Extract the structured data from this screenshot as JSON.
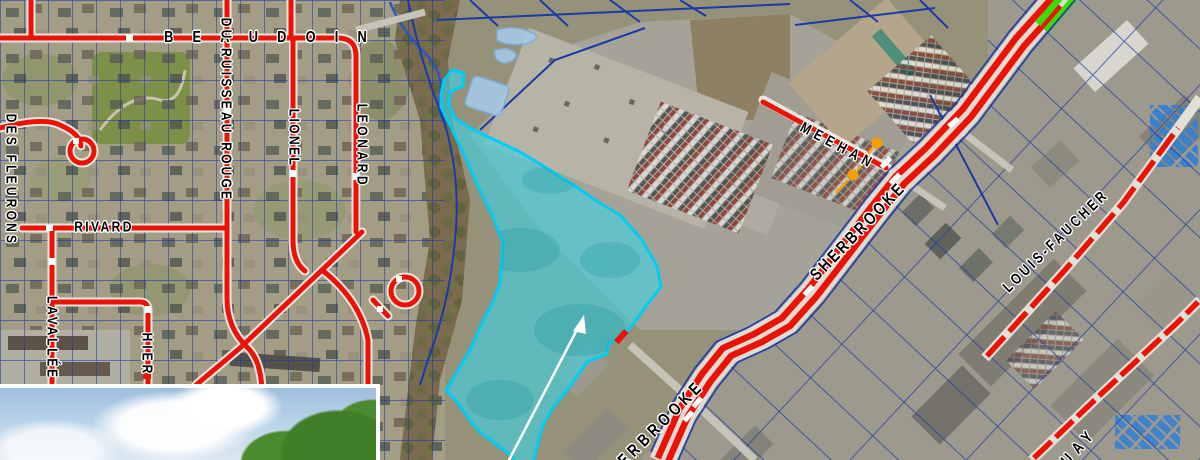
{
  "map": {
    "street_labels": [
      {
        "text": "BEAUDOIN",
        "x": 275,
        "y": 38,
        "rot": 0,
        "fs": 16,
        "ls": 24
      },
      {
        "text": "DU RUISSEAU ROUGE",
        "x": 226,
        "y": 110,
        "rot": 90,
        "fs": 15,
        "ls": 4
      },
      {
        "text": "LIONEL",
        "x": 294,
        "y": 138,
        "rot": 90,
        "fs": 15,
        "ls": 3
      },
      {
        "text": "LEONARD",
        "x": 362,
        "y": 146,
        "rot": 90,
        "fs": 15,
        "ls": 4.5
      },
      {
        "text": "RIVARD",
        "x": 104,
        "y": 227,
        "rot": 0,
        "fs": 15,
        "ls": 3
      },
      {
        "text": "DES FLEURONS",
        "x": 11,
        "y": 180,
        "rot": 90,
        "fs": 15,
        "ls": 4
      },
      {
        "text": "LAVALLÉE",
        "x": 52,
        "y": 338,
        "rot": 90,
        "fs": 15,
        "ls": 3.5
      },
      {
        "text": "HIER",
        "x": 147,
        "y": 355,
        "rot": 90,
        "fs": 15,
        "ls": 5
      },
      {
        "text": "MEEHAN",
        "x": 838,
        "y": 146,
        "rot": 28,
        "fs": 15,
        "ls": 6.5
      },
      {
        "text": "SHERBROOKE",
        "x": 858,
        "y": 231,
        "rot": -46,
        "fs": 17,
        "ls": 4
      },
      {
        "text": "ERBROOKE",
        "x": 661,
        "y": 423,
        "rot": -45,
        "fs": 17,
        "ls": 5.5
      },
      {
        "text": "LOUIS-FAUCHER",
        "x": 1056,
        "y": 241,
        "rot": -44,
        "fs": 15,
        "ls": 4
      },
      {
        "text": "UAY",
        "x": 1080,
        "y": 447,
        "rot": -48,
        "fs": 16,
        "ls": 8
      }
    ],
    "legend_colors": {
      "highlighted_street": "#ea1305",
      "street_casing": "#e9e8e0",
      "parcel_line": "#1a3aa8",
      "selected_area_fill": "#3fd4e4",
      "selected_area_outline": "#00ccf5",
      "special_segment_green": "#3bdc00",
      "point_marker_orange": "#f59e00",
      "pond_fill": "#a6c9e6",
      "callout_arrow": "#ffffff"
    },
    "markers": {
      "orange_points": [
        {
          "x": 877,
          "y": 143
        },
        {
          "x": 853,
          "y": 175
        }
      ],
      "red_stub": {
        "x": 621,
        "y": 337
      }
    }
  }
}
